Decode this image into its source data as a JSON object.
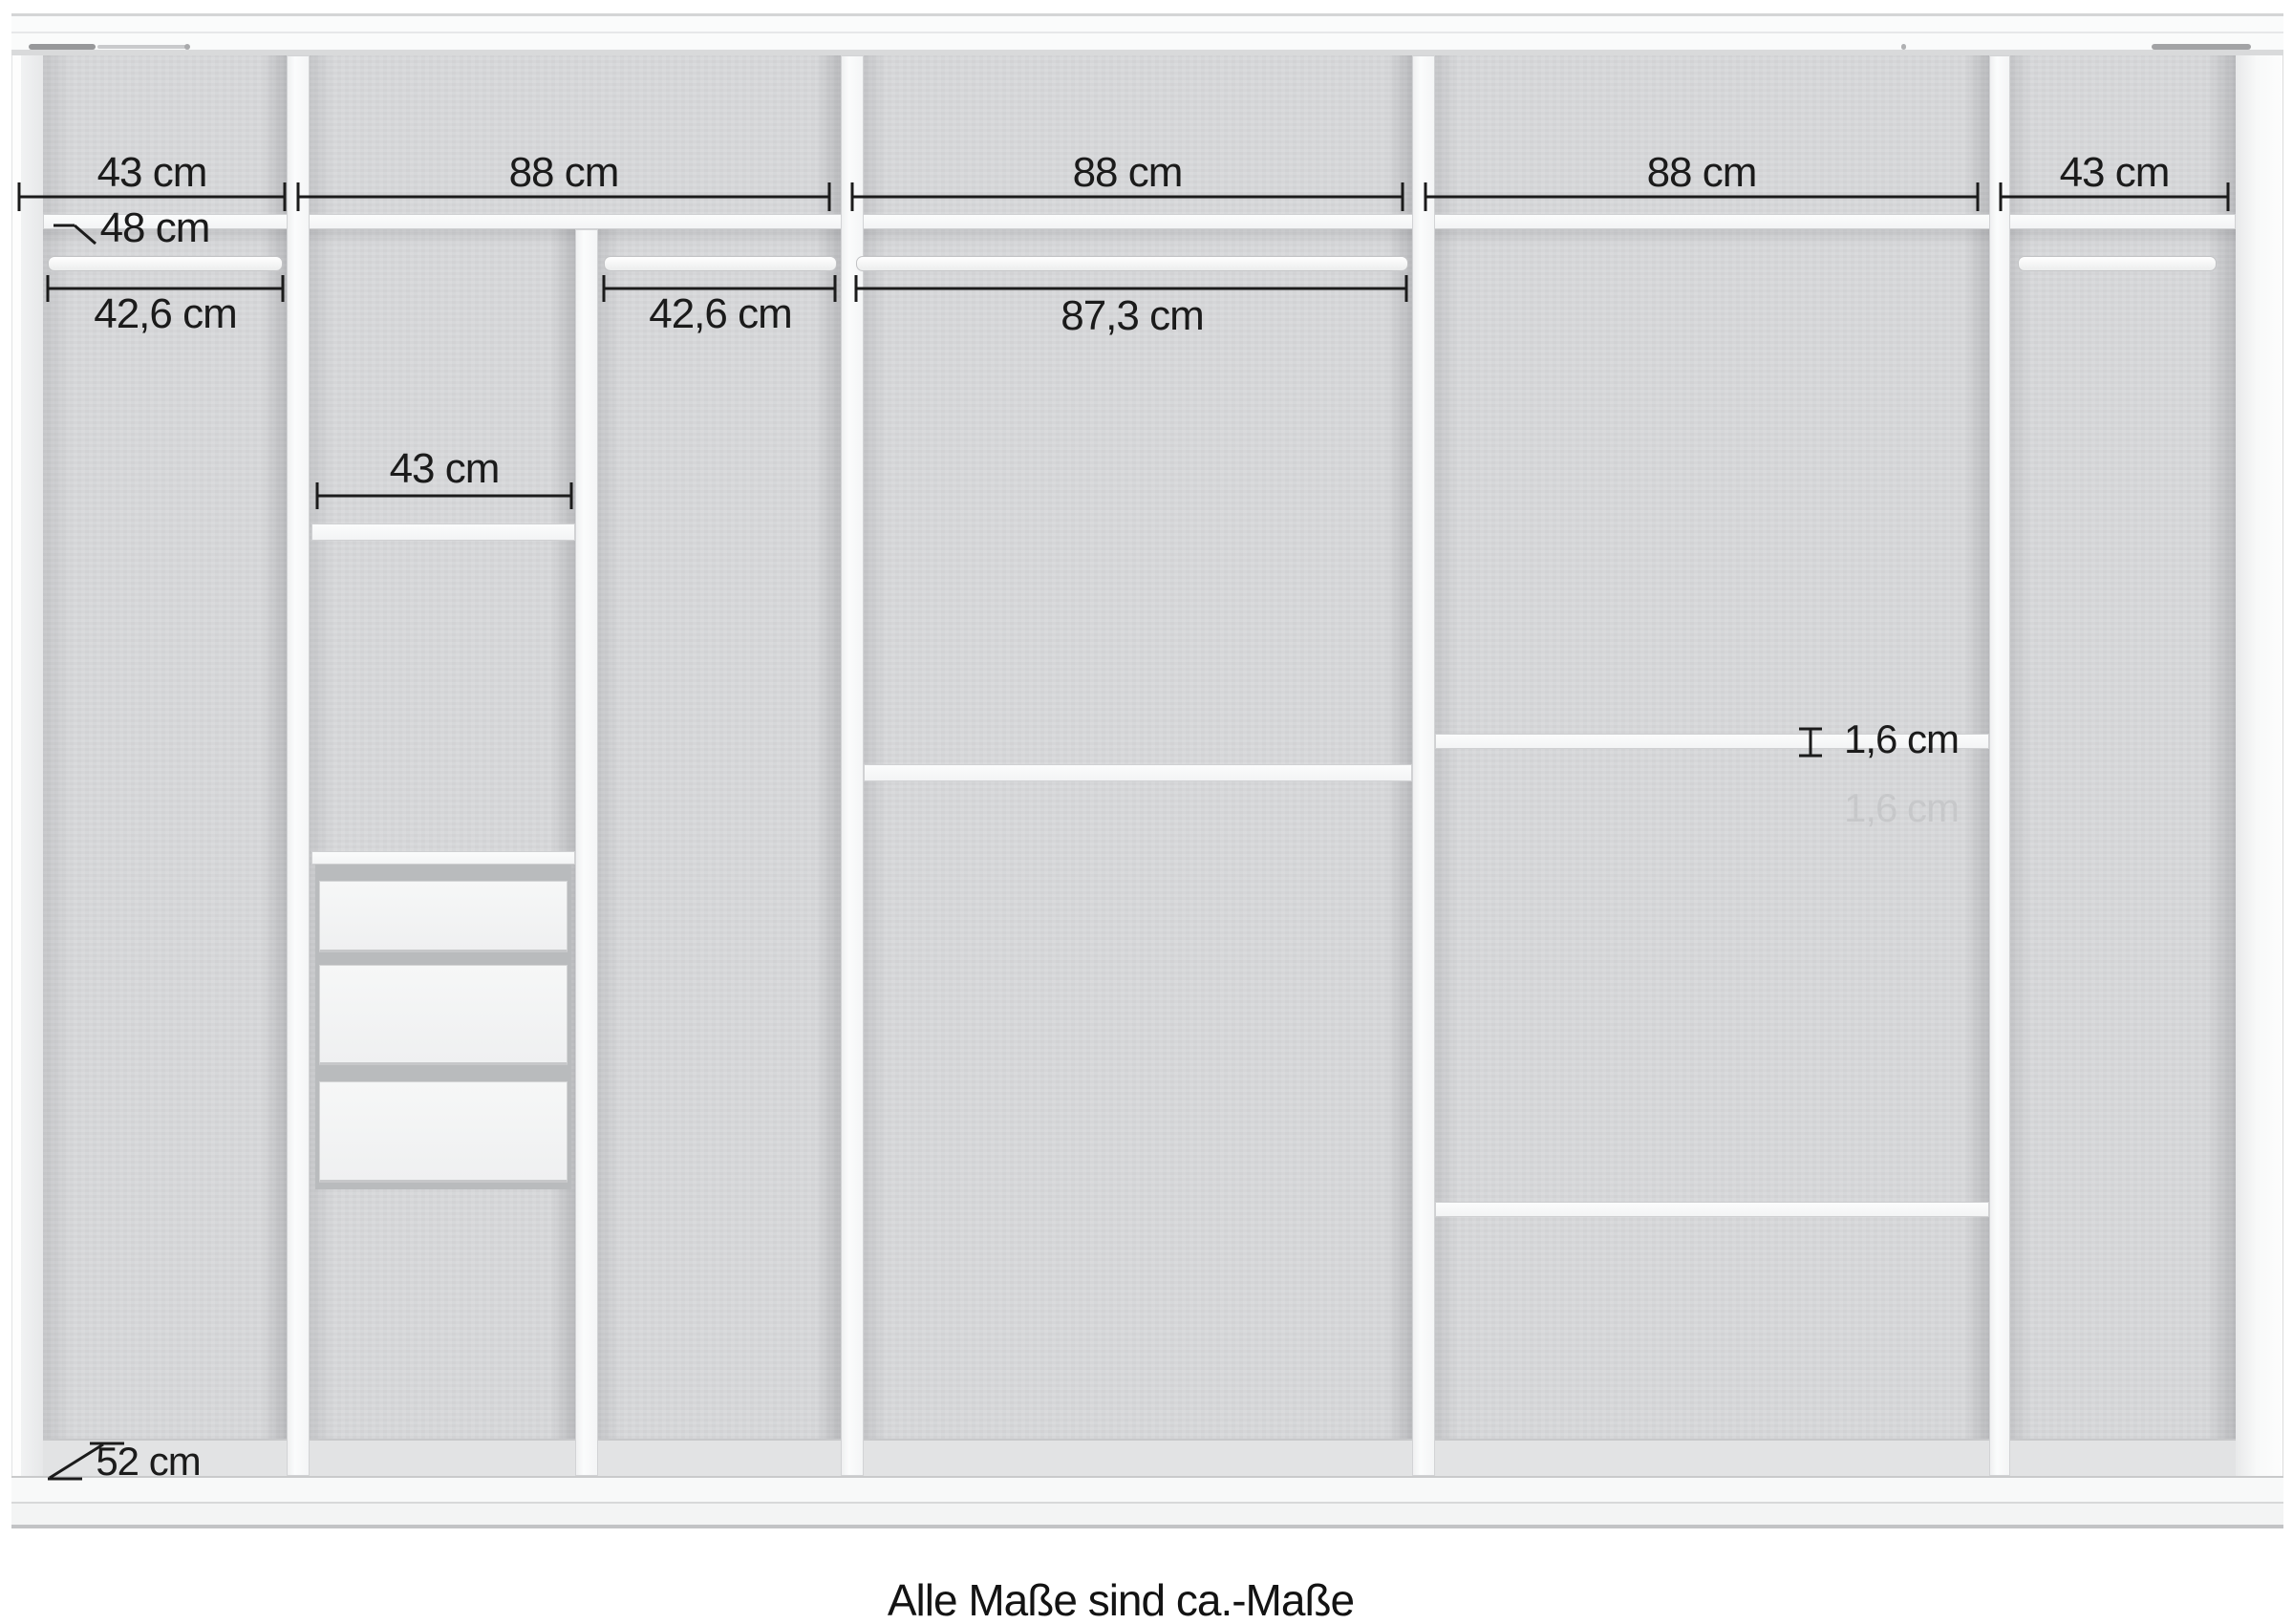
{
  "figure": {
    "type": "wardrobe-interior-dimension-diagram",
    "caption": "Alle Maße sind ca.-Maße",
    "units": "cm"
  },
  "top_dimensions": [
    "43 cm",
    "88 cm",
    "88 cm",
    "88 cm",
    "43 cm"
  ],
  "interior_dimensions": {
    "left_rail_width": "42,6 cm",
    "top_shelf_depth": "48 cm",
    "shelf_column_width": "43 cm",
    "center_left_rail_width": "42,6 cm",
    "center_rail_width": "87,3 cm",
    "shelf_thickness": "1,6 cm",
    "shelf_thickness_ghost": "1,6 cm",
    "base_depth": "52 cm"
  },
  "structure": {
    "sections": 5,
    "clothes_rails": 4,
    "drawers": 3,
    "shelves": 7
  },
  "colors": {
    "background": "#ffffff",
    "interior_gray": "#d8d9db",
    "panel_white": "#f8f9fa",
    "dimension_line": "#1b1b1b",
    "ghost_text": "#c7c8ca"
  }
}
